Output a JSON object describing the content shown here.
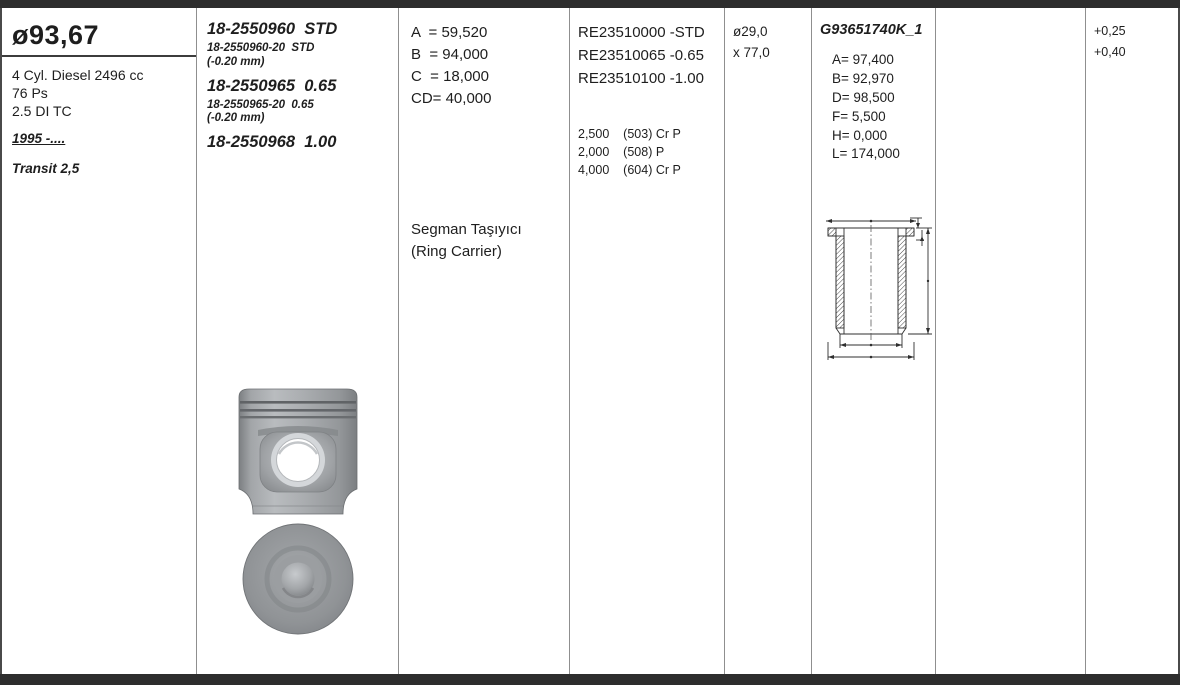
{
  "colors": {
    "frame_dark": "#2d2d2d",
    "grid_line": "#8f8f8f",
    "text": "#1e1e1e",
    "piston_gray": "#96999c",
    "drawing_line": "#2f2f2f"
  },
  "engine": {
    "bore_diameter": "ø93,67",
    "description": "4 Cyl. Diesel 2496 cc",
    "power": "76 Ps",
    "spec": "2.5 DI TC",
    "years": "1995 -....",
    "model": "Transit 2,5"
  },
  "piston_numbers": {
    "main1": "18-2550960  STD",
    "sub1a": "18-2550960-20  STD",
    "sub1b": "(-0.20 mm)",
    "main2": "18-2550965  0.65",
    "sub2a": "18-2550965-20  0.65",
    "sub2b": "(-0.20 mm)",
    "main3": "18-2550968  1.00"
  },
  "piston_dimensions": {
    "a": "A  = 59,520",
    "b": "B  = 94,000",
    "c": "C  = 18,000",
    "cd": "CD= 40,000",
    "note_line1": "Segman Taşıyıcı",
    "note_line2": "(Ring Carrier)"
  },
  "ring_sets": {
    "ref1": "RE23510000 -STD",
    "ref2": "RE23510065 -0.65",
    "ref3": "RE23510100 -1.00",
    "ring1": "2,500    (503) Cr P",
    "ring2": "2,000    (508) P",
    "ring3": "4,000    (604) Cr P"
  },
  "pin": {
    "diameter": "ø29,0",
    "length": "x 77,0"
  },
  "liner": {
    "code": "G93651740K_1",
    "a": "A= 97,400",
    "b": "B= 92,970",
    "d": "D= 98,500",
    "f": "F= 5,500",
    "h": "H= 0,000",
    "l": "L= 174,000"
  },
  "oversizes": {
    "o1": "+0,25",
    "o2": "+0,40"
  }
}
